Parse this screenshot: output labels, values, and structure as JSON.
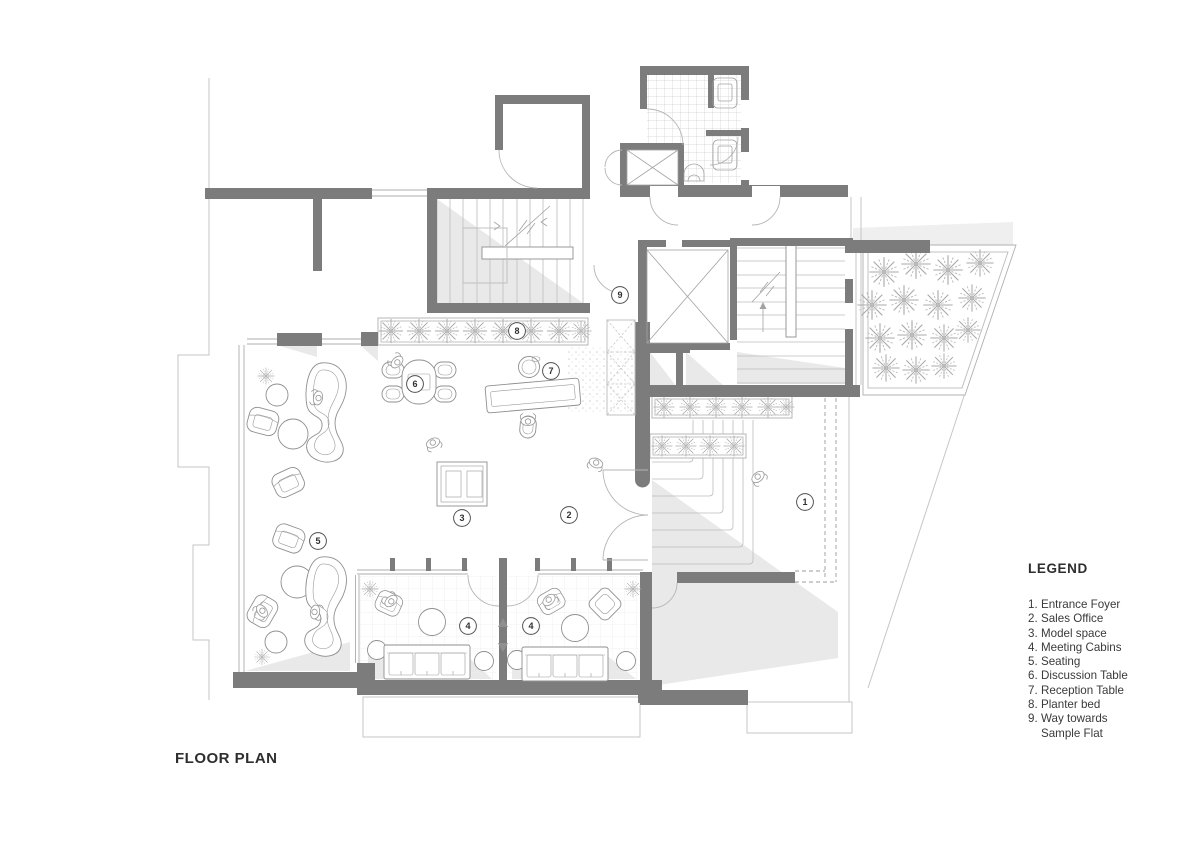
{
  "title": "FLOOR PLAN",
  "legend": {
    "heading": "LEGEND",
    "items": [
      {
        "num": "1.",
        "label": "Entrance Foyer"
      },
      {
        "num": "2.",
        "label": "Sales Office"
      },
      {
        "num": "3.",
        "label": "Model space"
      },
      {
        "num": "4.",
        "label": "Meeting Cabins"
      },
      {
        "num": "5.",
        "label": "Seating"
      },
      {
        "num": "6.",
        "label": "Discussion Table"
      },
      {
        "num": "7.",
        "label": "Reception Table"
      },
      {
        "num": "8.",
        "label": "Planter bed"
      },
      {
        "num": "9.",
        "label": "Way towards Sample Flat"
      }
    ]
  },
  "markers": [
    {
      "n": "1",
      "x": 805,
      "y": 502
    },
    {
      "n": "2",
      "x": 569,
      "y": 515
    },
    {
      "n": "3",
      "x": 462,
      "y": 518
    },
    {
      "n": "4",
      "x": 468,
      "y": 626
    },
    {
      "n": "4",
      "x": 531,
      "y": 626
    },
    {
      "n": "5",
      "x": 318,
      "y": 541
    },
    {
      "n": "6",
      "x": 415,
      "y": 384
    },
    {
      "n": "7",
      "x": 551,
      "y": 371
    },
    {
      "n": "8",
      "x": 517,
      "y": 331
    },
    {
      "n": "9",
      "x": 620,
      "y": 295
    }
  ],
  "colors": {
    "wall": "#7c7c7c",
    "floor_shading": "#e9e9e9",
    "line": "#bdbdbd",
    "text": "#2e2e2e"
  }
}
